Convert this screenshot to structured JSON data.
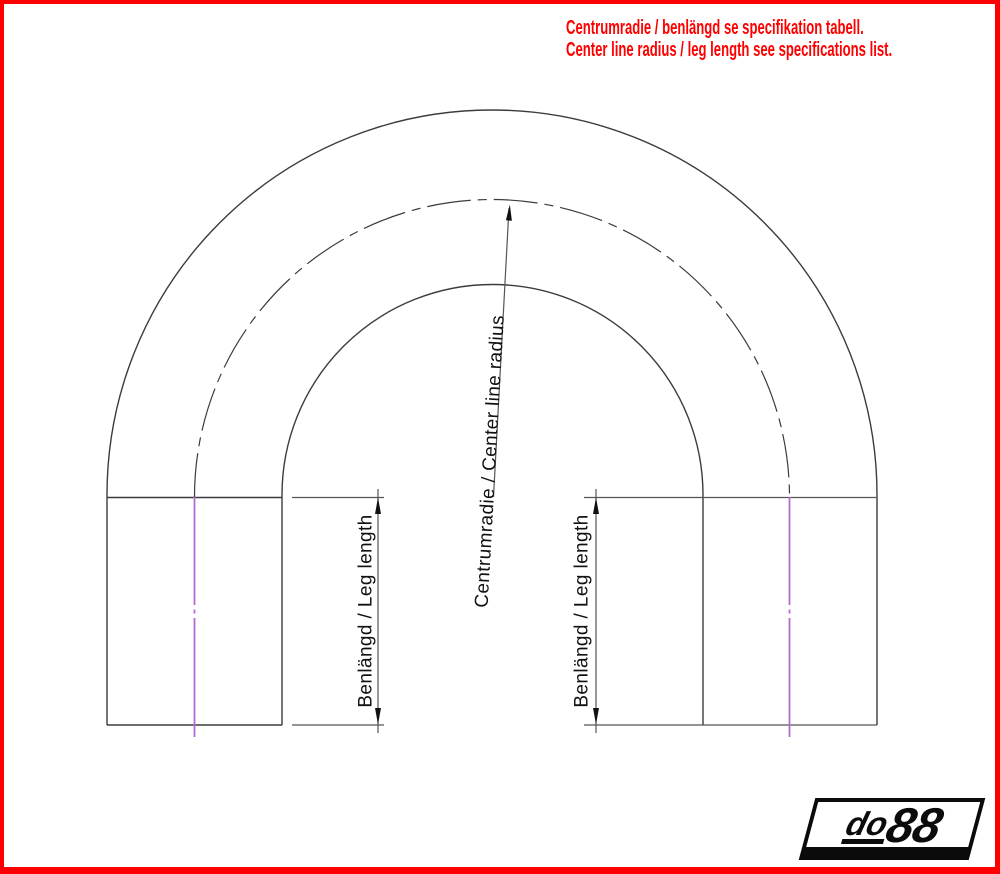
{
  "notice": {
    "line1": "Centrumradie / benlängd se specifikation tabell.",
    "line2": "Center line radius / leg length see specifications list."
  },
  "drawing": {
    "center_radius_label": "Centrumradie / Center line radius",
    "leg_length_label": "Benlängd / Leg length"
  },
  "logo": {
    "prefix": "do",
    "suffix": "88"
  },
  "colors": {
    "accent_red": "#FE0000",
    "geometry_gray": "#3C3C3C",
    "centerline_magenta": "#B56AD2",
    "arrow_black": "#111111",
    "logo_black": "#0B0B0B"
  }
}
